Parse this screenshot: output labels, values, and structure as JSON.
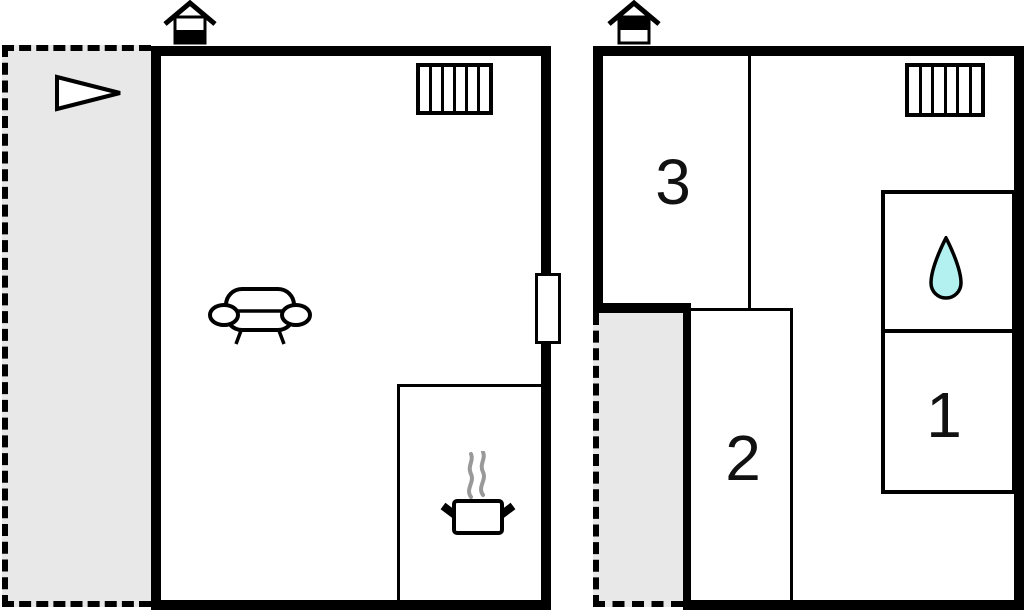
{
  "first_floor": {
    "rooms": [
      {
        "label": "3"
      },
      {
        "label": "2"
      },
      {
        "label": "1"
      }
    ]
  },
  "radiator": {
    "slats": 6
  },
  "icons": {
    "ground_entrance": "house-entrance-ground-icon",
    "first_entrance": "house-entrance-first-icon",
    "direction": "direction-arrow-icon",
    "sofa": "sofa-icon",
    "cooking": "cooking-pot-icon",
    "water": "water-drop-icon",
    "radiator": "radiator-icon",
    "window": "window-door-icon"
  },
  "colors": {
    "wall": "#000000",
    "terrace_fill": "#e8e8e8",
    "drop_fill": "#b3f1f1",
    "steam": "#999999",
    "bg": "#ffffff"
  }
}
